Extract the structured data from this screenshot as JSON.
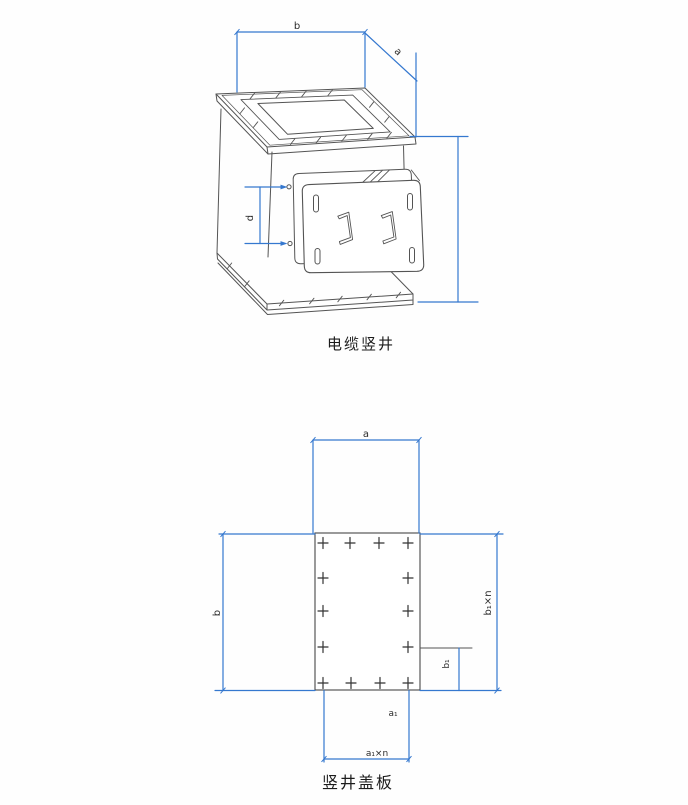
{
  "colors": {
    "dimension_blue": "#3578cf",
    "drawing_line": "#545454",
    "text": "#1c1c1c",
    "background": "#fefefe"
  },
  "figure1": {
    "caption": "电缆竖井",
    "dim_labels": {
      "b": "b",
      "a": "a",
      "d": "d"
    }
  },
  "figure2": {
    "caption": "竖井盖板",
    "dim_labels": {
      "a": "a",
      "b": "b",
      "b1": "b₁",
      "b1xn": "b₁×n",
      "a1": "a₁",
      "a1xn": "a₁×n"
    }
  }
}
